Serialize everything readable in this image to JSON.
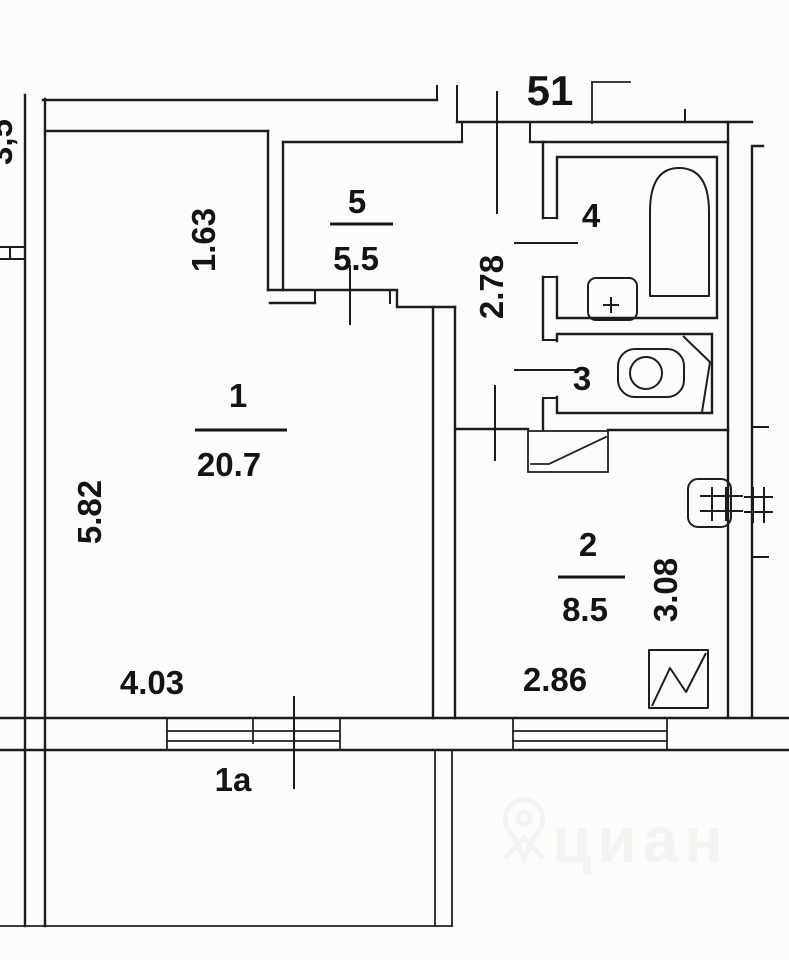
{
  "plan": {
    "apartment_number": "51",
    "left_edge_clipped_dim": "3,5",
    "rooms": {
      "room1": {
        "number": "1",
        "area": "20.7"
      },
      "room1a": {
        "number": "1a"
      },
      "room2": {
        "number": "2",
        "area": "8.5"
      },
      "room3": {
        "number": "3"
      },
      "room4": {
        "number": "4"
      },
      "room5": {
        "number": "5",
        "area": "5.5"
      }
    },
    "dimensions": {
      "room1_width": "4.03",
      "room1_depth": "5.82",
      "room5_width": "1.63",
      "corridor_depth": "2.78",
      "room2_width": "2.86",
      "room2_depth": "3.08"
    },
    "watermark": "циан",
    "colors": {
      "line": "#1c1c1c",
      "background": "#fcfcfa",
      "watermark": "#ededeb"
    }
  }
}
